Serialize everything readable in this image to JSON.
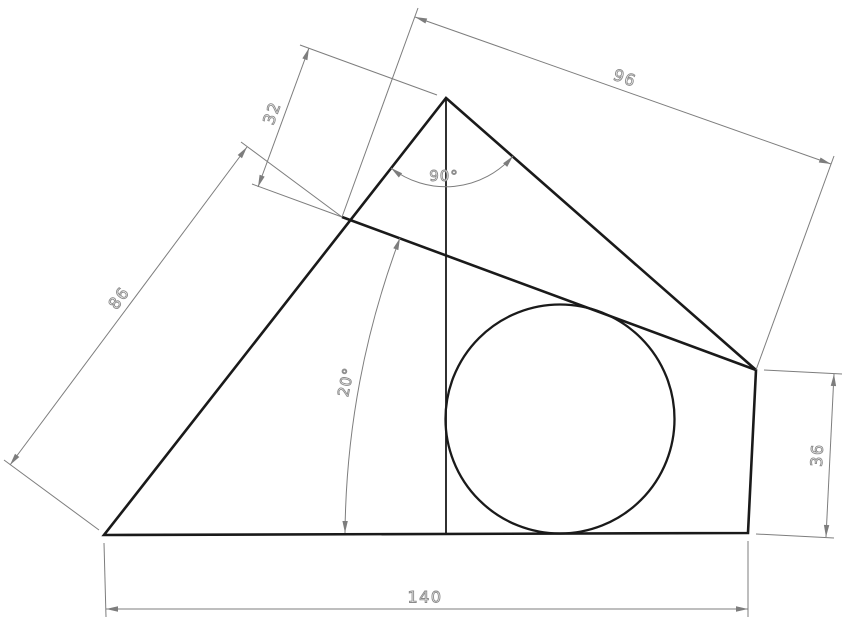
{
  "drawing": {
    "labels": {
      "dim_32": "32",
      "dim_96": "96",
      "dim_86": "86",
      "dim_140": "140",
      "dim_36": "36",
      "angle_90": "90°",
      "angle_20": "20°"
    },
    "colors": {
      "geometry_line": "#1a1a1a",
      "dimension_line": "#7d7d7d",
      "dimension_text_outline": "#8a8a8a",
      "background": "#ffffff"
    }
  }
}
